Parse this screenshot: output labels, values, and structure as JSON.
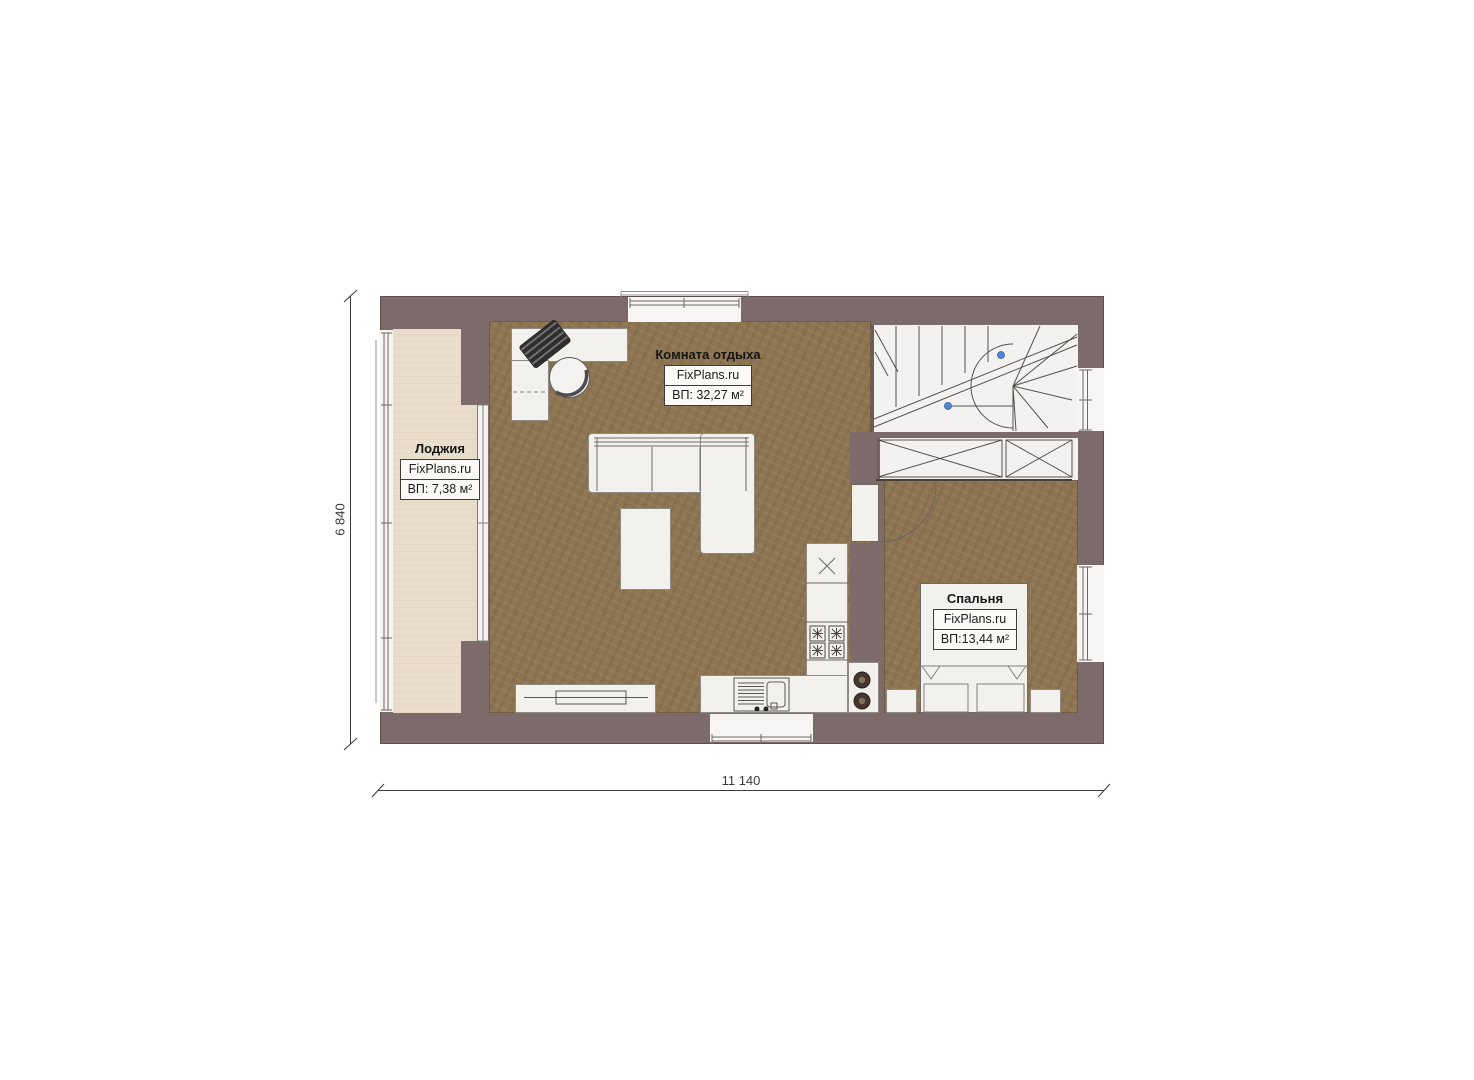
{
  "plan": {
    "rooms": [
      {
        "name": "rest-room",
        "title": "Комната отдыха",
        "brand": "FixPlans.ru",
        "area": "ВП: 32,27 м²"
      },
      {
        "name": "loggia",
        "title": "Лоджия",
        "brand": "FixPlans.ru",
        "area": "ВП: 7,38 м²"
      },
      {
        "name": "bedroom",
        "title": "Спальня",
        "brand": "FixPlans.ru",
        "area": "ВП:13,44 м²"
      }
    ],
    "dimensions": {
      "height_label": "6 840",
      "width_label": "11 140"
    },
    "colors": {
      "wall": "#7d6a6b",
      "floor": "#8e7552",
      "loggia_floor": "#e9decc",
      "furniture": "#f2f1ee",
      "stairs_area": "#f3f2f0",
      "marker_blue": "#4f86d6",
      "line": "#56504b"
    },
    "elements": [
      "staircase",
      "wardrobe",
      "desk",
      "office-chair",
      "laptop",
      "sofa",
      "coffee-table",
      "tv-stand",
      "kitchen-counter",
      "stove",
      "sink",
      "appliance",
      "bed",
      "nightstand",
      "door",
      "window"
    ]
  }
}
